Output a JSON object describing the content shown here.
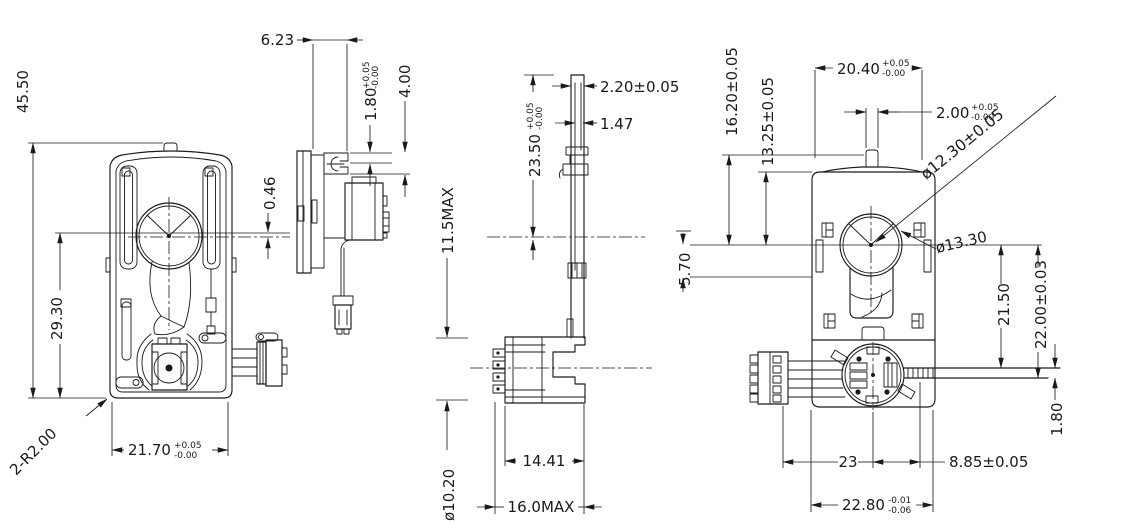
{
  "colors": {
    "background": "#ffffff",
    "line": "#1a1a1a"
  },
  "dims": {
    "front": {
      "overall_height": "45.50",
      "center_to_bottom": "29.30",
      "corner_radius": "2-R2.00",
      "body_width": "21.70",
      "body_width_tol_upper": "+0.05",
      "body_width_tol_lower": "-0.00",
      "center_offset": "0.46"
    },
    "side": {
      "flange_to_clip": "6.23",
      "clip_slot": "1.80",
      "clip_slot_tol_upper": "+0.05",
      "clip_slot_tol_lower": "-0.00",
      "clip_depth": "4.00"
    },
    "profile": {
      "lever_tip_width": "2.20±0.05",
      "lever_thickness": "1.47",
      "lever_length": "23.50",
      "lever_length_tol_upper": "+0.05",
      "lever_length_tol_lower": "-0.00",
      "gearbox_height": "11.5MAX",
      "motor_diameter": "ø10.20",
      "gearbox_depth": "14.41",
      "overall_depth": "16.0MAX"
    },
    "rear": {
      "shoulder_width": "20.40",
      "shoulder_width_tol_upper": "+0.05",
      "shoulder_width_tol_lower": "-0.00",
      "shaft_width": "2.00",
      "shaft_width_tol_upper": "+0.05",
      "shaft_width_tol_lower": "-0.00",
      "bore_diameter": "ø12.30±0.05",
      "boss_diameter": "ø13.30",
      "step_height": "5.70",
      "shoulder_height": "16.20±0.05",
      "flange_height": "13.25±0.05",
      "arm_top_offset": "21.50",
      "arm_bottom_offset": "22.00±0.03",
      "arm_thickness": "1.80",
      "motor_center_offset": "23",
      "arm_start_offset": "8.85±0.05",
      "body_width": "22.80",
      "body_width_tol_upper": "-0.01",
      "body_width_tol_lower": "-0.06"
    }
  }
}
